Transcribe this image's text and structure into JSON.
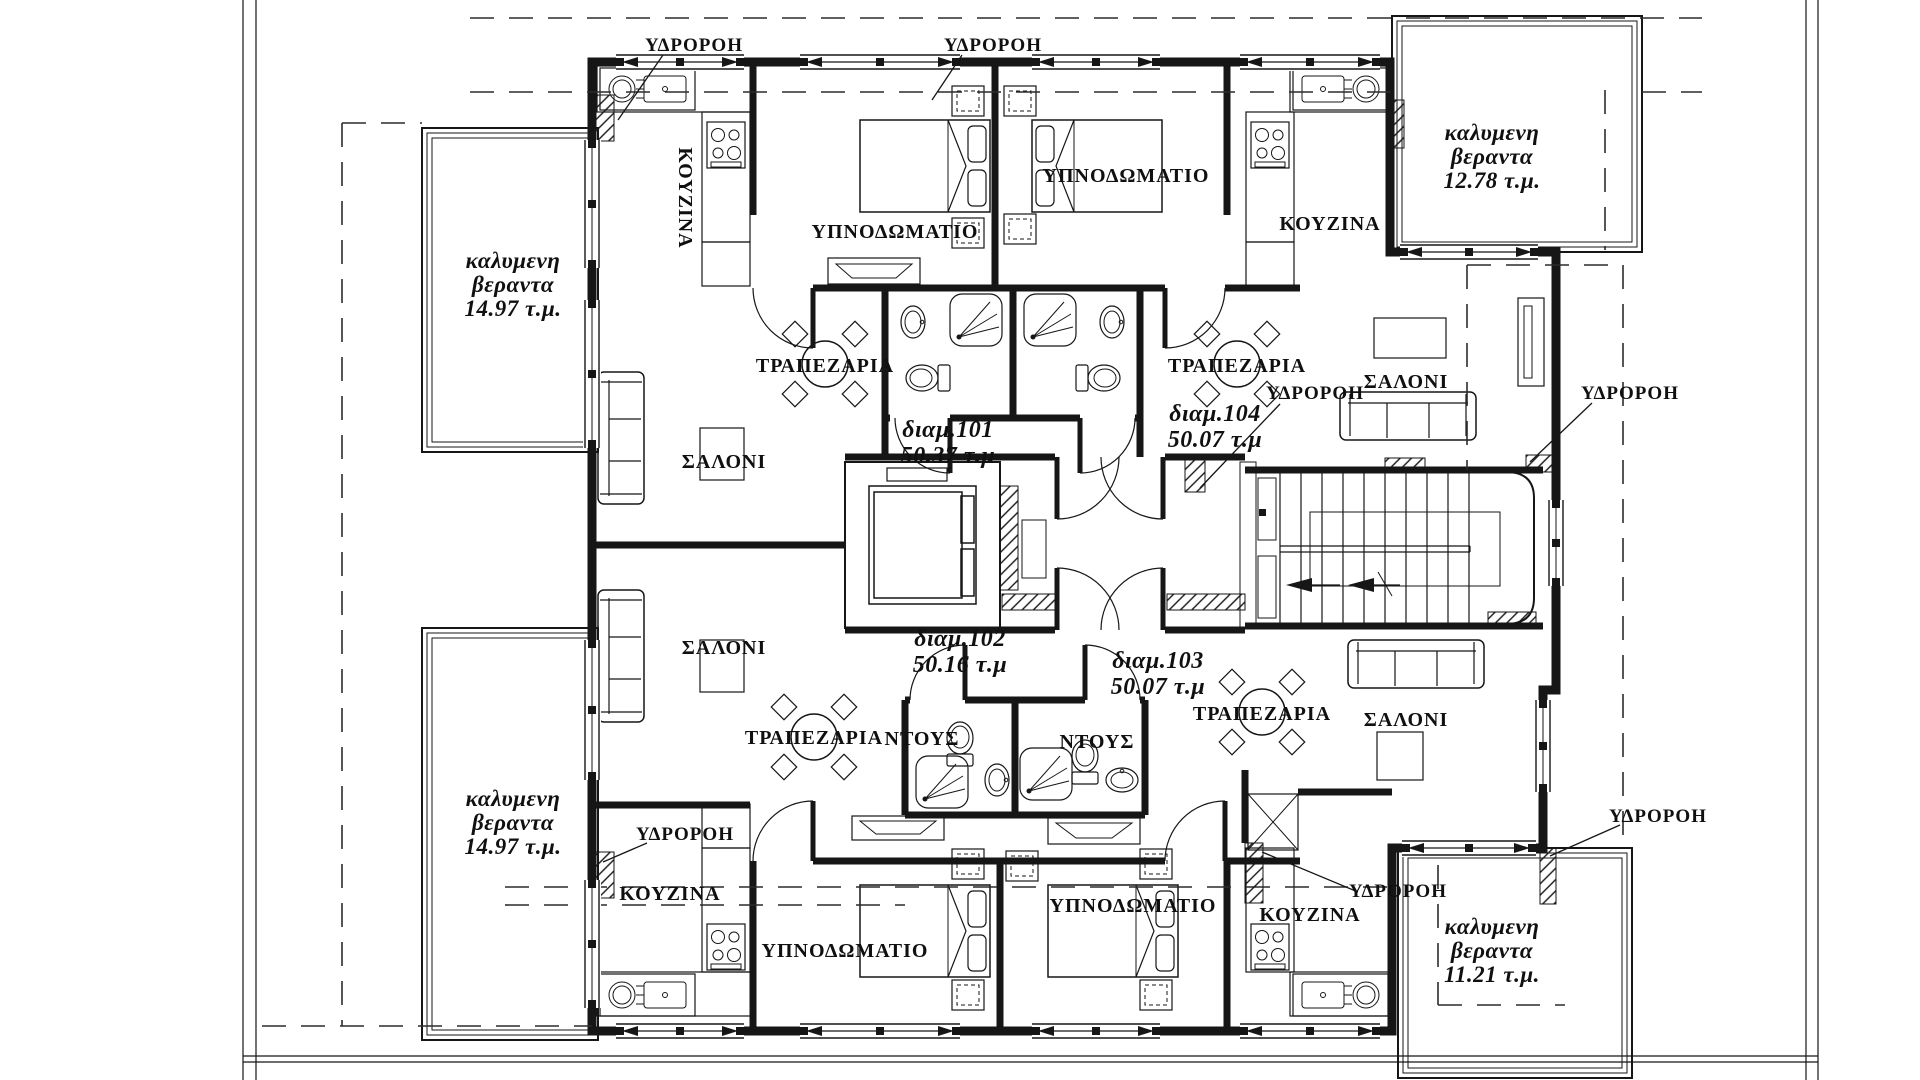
{
  "plan": {
    "labels": {
      "downspout": "ΥΔΡΟΡΟΗ",
      "kitchen": "ΚΟΥΖΙΝΑ",
      "bedroom": "ΥΠΝΟΔΩΜΑΤΙΟ",
      "dining": "ΤΡΑΠΕΖΑΡΙΑ",
      "living": "ΣΑΛΟΝΙ",
      "shower": "ΝΤΟΥΣ",
      "veranda_line1": "καλυμενη",
      "veranda_line2": "βεραντα"
    },
    "apartments": [
      {
        "name": "διαμ.101",
        "area": "50.37 τ.μ"
      },
      {
        "name": "διαμ.102",
        "area": "50.16 τ.μ"
      },
      {
        "name": "διαμ.103",
        "area": "50.07 τ.μ"
      },
      {
        "name": "διαμ.104",
        "area": "50.07 τ.μ"
      }
    ],
    "verandas": [
      {
        "id": "left-top",
        "area": "14.97 τ.μ."
      },
      {
        "id": "left-bottom",
        "area": "14.97 τ.μ."
      },
      {
        "id": "top-right",
        "area": "12.78 τ.μ."
      },
      {
        "id": "bottom-right",
        "area": "11.21 τ.μ."
      }
    ],
    "colors": {
      "ink": "#161616",
      "paper": "#ffffff"
    }
  }
}
